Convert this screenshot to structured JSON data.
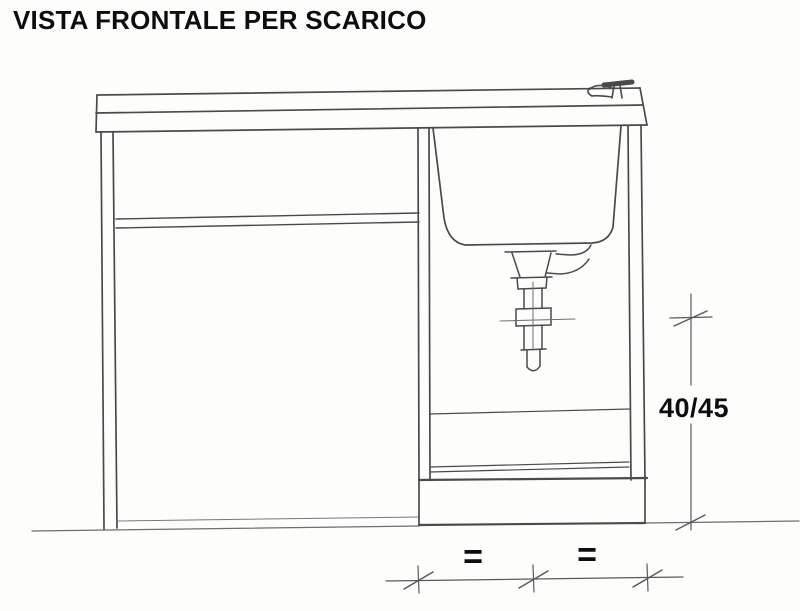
{
  "title": "VISTA FRONTALE PER SCARICO",
  "labels": {
    "dim_height": "40/45",
    "eq_left": "=",
    "eq_right": "="
  },
  "colors": {
    "paper": "#fdfdfc",
    "ink": "#4a4a4a",
    "ink_light": "#6d6d6d",
    "text": "#0d0d0d"
  },
  "parts": [
    "countertop",
    "faucet",
    "left-leg",
    "shelf",
    "left-compartment-base",
    "divider-panel",
    "right-side-panel",
    "sink-basin",
    "overflow-pipe",
    "drain-trap",
    "drain-centerlines",
    "cabinet-interior-lines",
    "plinth",
    "ground-line",
    "height-dimension",
    "equal-spacing-dimension"
  ]
}
